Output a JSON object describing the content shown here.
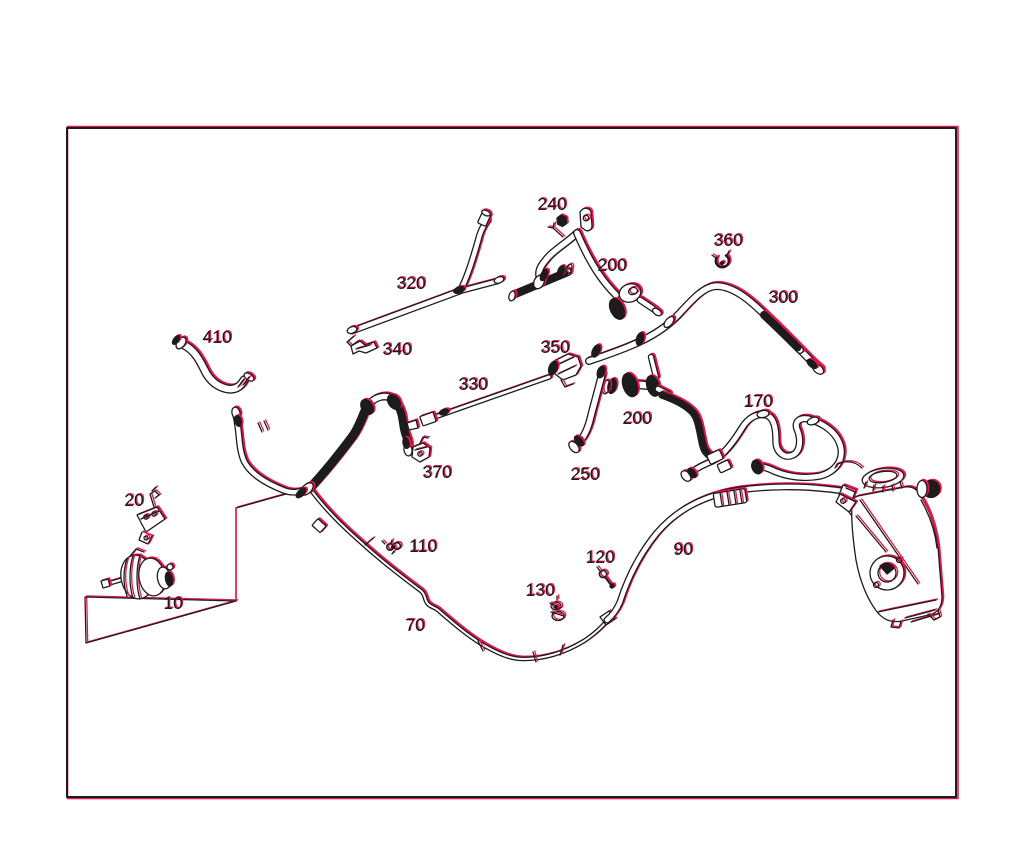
{
  "meta": {
    "kind": "technical-parts-diagram",
    "subject": "engine cooling system hose and line routing with numbered part callouts"
  },
  "canvas": {
    "width": 1024,
    "height": 851,
    "background": "#ffffff"
  },
  "frame": {
    "x": 67,
    "y": 128,
    "width": 889,
    "height": 669
  },
  "colors": {
    "ink": "#1c1c1c",
    "accent": "#e8174a",
    "paper": "#ffffff"
  },
  "part_labels": [
    {
      "part": "240",
      "x": 552,
      "y": 210
    },
    {
      "part": "360",
      "x": 728,
      "y": 246
    },
    {
      "part": "200",
      "x": 612,
      "y": 271
    },
    {
      "part": "320",
      "x": 411,
      "y": 289
    },
    {
      "part": "300",
      "x": 783,
      "y": 303
    },
    {
      "part": "410",
      "x": 217,
      "y": 343
    },
    {
      "part": "340",
      "x": 397,
      "y": 355
    },
    {
      "part": "350",
      "x": 555,
      "y": 353
    },
    {
      "part": "330",
      "x": 473,
      "y": 390
    },
    {
      "part": "170",
      "x": 758,
      "y": 407
    },
    {
      "part": "200",
      "x": 637,
      "y": 424
    },
    {
      "part": "370",
      "x": 437,
      "y": 478
    },
    {
      "part": "250",
      "x": 585,
      "y": 480
    },
    {
      "part": "20",
      "x": 134,
      "y": 506
    },
    {
      "part": "110",
      "x": 423,
      "y": 552
    },
    {
      "part": "90",
      "x": 683,
      "y": 555
    },
    {
      "part": "120",
      "x": 600,
      "y": 563
    },
    {
      "part": "130",
      "x": 540,
      "y": 596
    },
    {
      "part": "10",
      "x": 173,
      "y": 609
    },
    {
      "part": "70",
      "x": 415,
      "y": 631
    }
  ]
}
